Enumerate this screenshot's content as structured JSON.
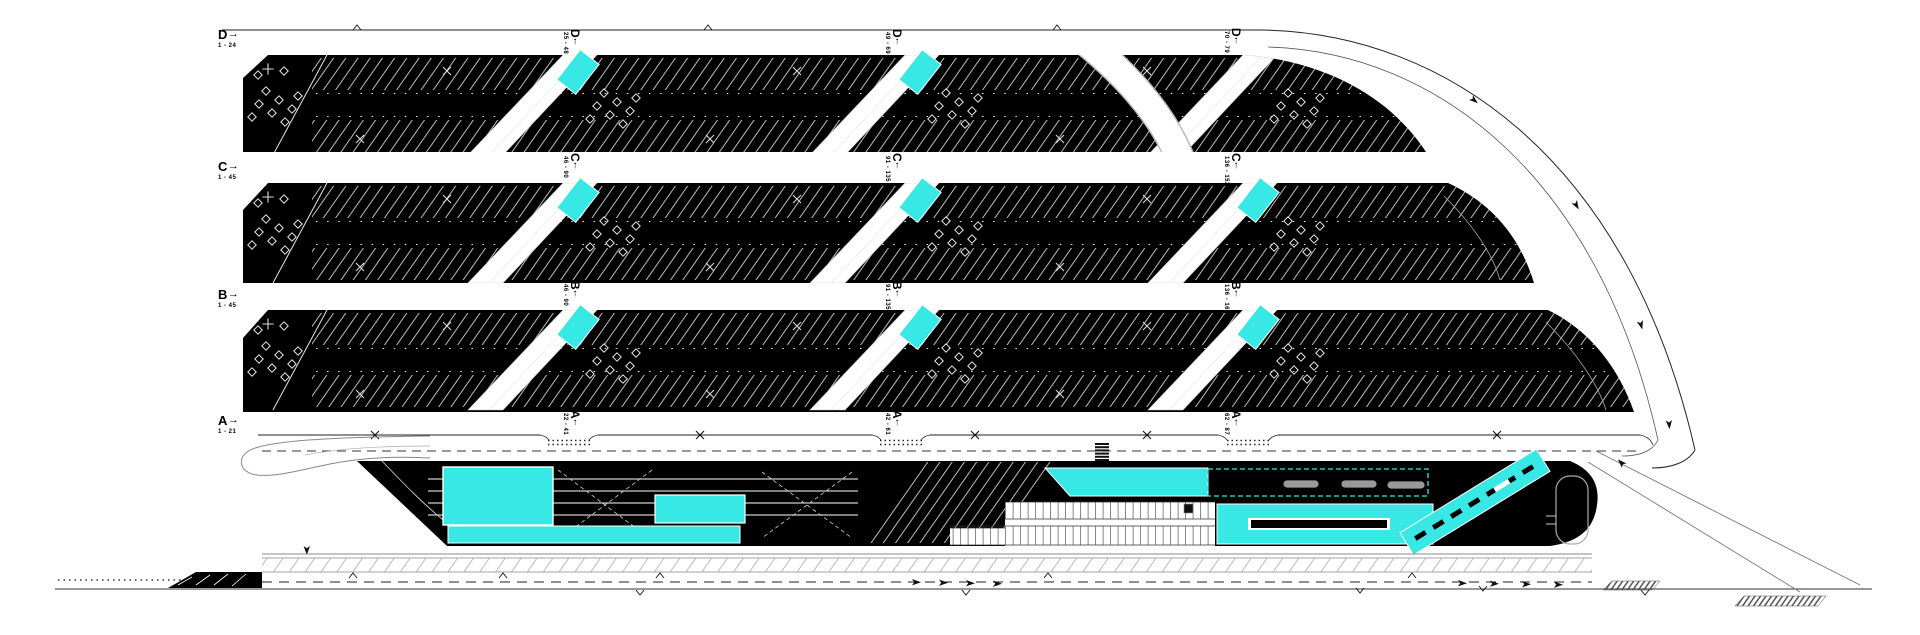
{
  "colors": {
    "accent": "#38e8e4",
    "ink": "#000000",
    "line": "#9aa0a3"
  },
  "rows": [
    {
      "id": "D",
      "sections": [
        {
          "letter": "D",
          "arrow": "→",
          "range": "1 - 24"
        },
        {
          "letter": "D",
          "arrow": "↑",
          "range": "25 - 48"
        },
        {
          "letter": "D",
          "arrow": "↑",
          "range": "49 - 69"
        },
        {
          "letter": "D",
          "arrow": "↑",
          "range": "70 - 79"
        }
      ]
    },
    {
      "id": "C",
      "sections": [
        {
          "letter": "C",
          "arrow": "→",
          "range": "1 - 45"
        },
        {
          "letter": "C",
          "arrow": "↑",
          "range": "46 - 90"
        },
        {
          "letter": "C",
          "arrow": "↑",
          "range": "91 - 135"
        },
        {
          "letter": "C",
          "arrow": "↑",
          "range": "136 - 152"
        }
      ]
    },
    {
      "id": "B",
      "sections": [
        {
          "letter": "B",
          "arrow": "→",
          "range": "1 - 45"
        },
        {
          "letter": "B",
          "arrow": "↑",
          "range": "46 - 90"
        },
        {
          "letter": "B",
          "arrow": "↑",
          "range": "91 - 135"
        },
        {
          "letter": "B",
          "arrow": "↑",
          "range": "136 - 164"
        }
      ]
    },
    {
      "id": "A",
      "sections": [
        {
          "letter": "A",
          "arrow": "→",
          "range": "1 - 21"
        },
        {
          "letter": "A",
          "arrow": "↑",
          "range": "22 - 41"
        },
        {
          "letter": "A",
          "arrow": "↑",
          "range": "42 - 61"
        },
        {
          "letter": "A",
          "arrow": "↑",
          "range": "62 - 87"
        }
      ]
    }
  ]
}
